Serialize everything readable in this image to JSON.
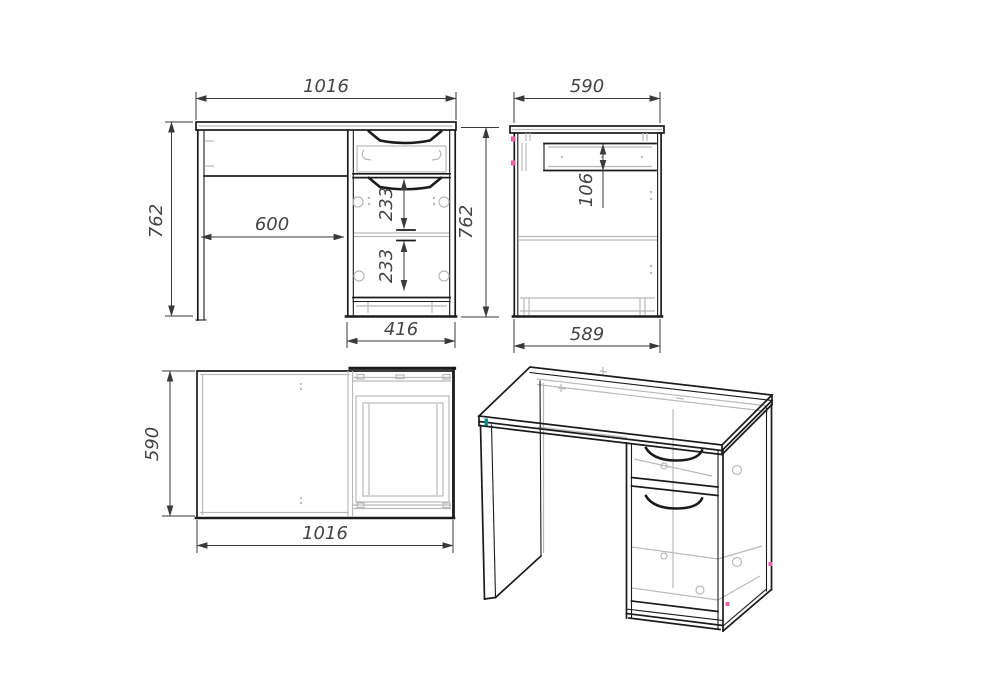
{
  "drawing": {
    "type": "furniture-technical-drawing",
    "subject": "desk-with-drawer-pedestal",
    "views": {
      "front": {
        "width": "1016",
        "height": "762",
        "knee_width": "600",
        "drawer_spacing_1": "233",
        "drawer_spacing_2": "233",
        "pedestal_width": "416"
      },
      "side": {
        "depth": "590",
        "height": "762",
        "drawer_height": "106",
        "base_depth": "589"
      },
      "top": {
        "depth": "590",
        "width": "1016"
      }
    },
    "colors": {
      "line": "#1b1b1b",
      "detail_gray": "#b9b9b9",
      "dimension": "#3a3a3a",
      "text": "#444444",
      "accent_pink": "#f25fa8",
      "accent_teal": "#0d8d8d",
      "bg": "#ffffff"
    }
  }
}
